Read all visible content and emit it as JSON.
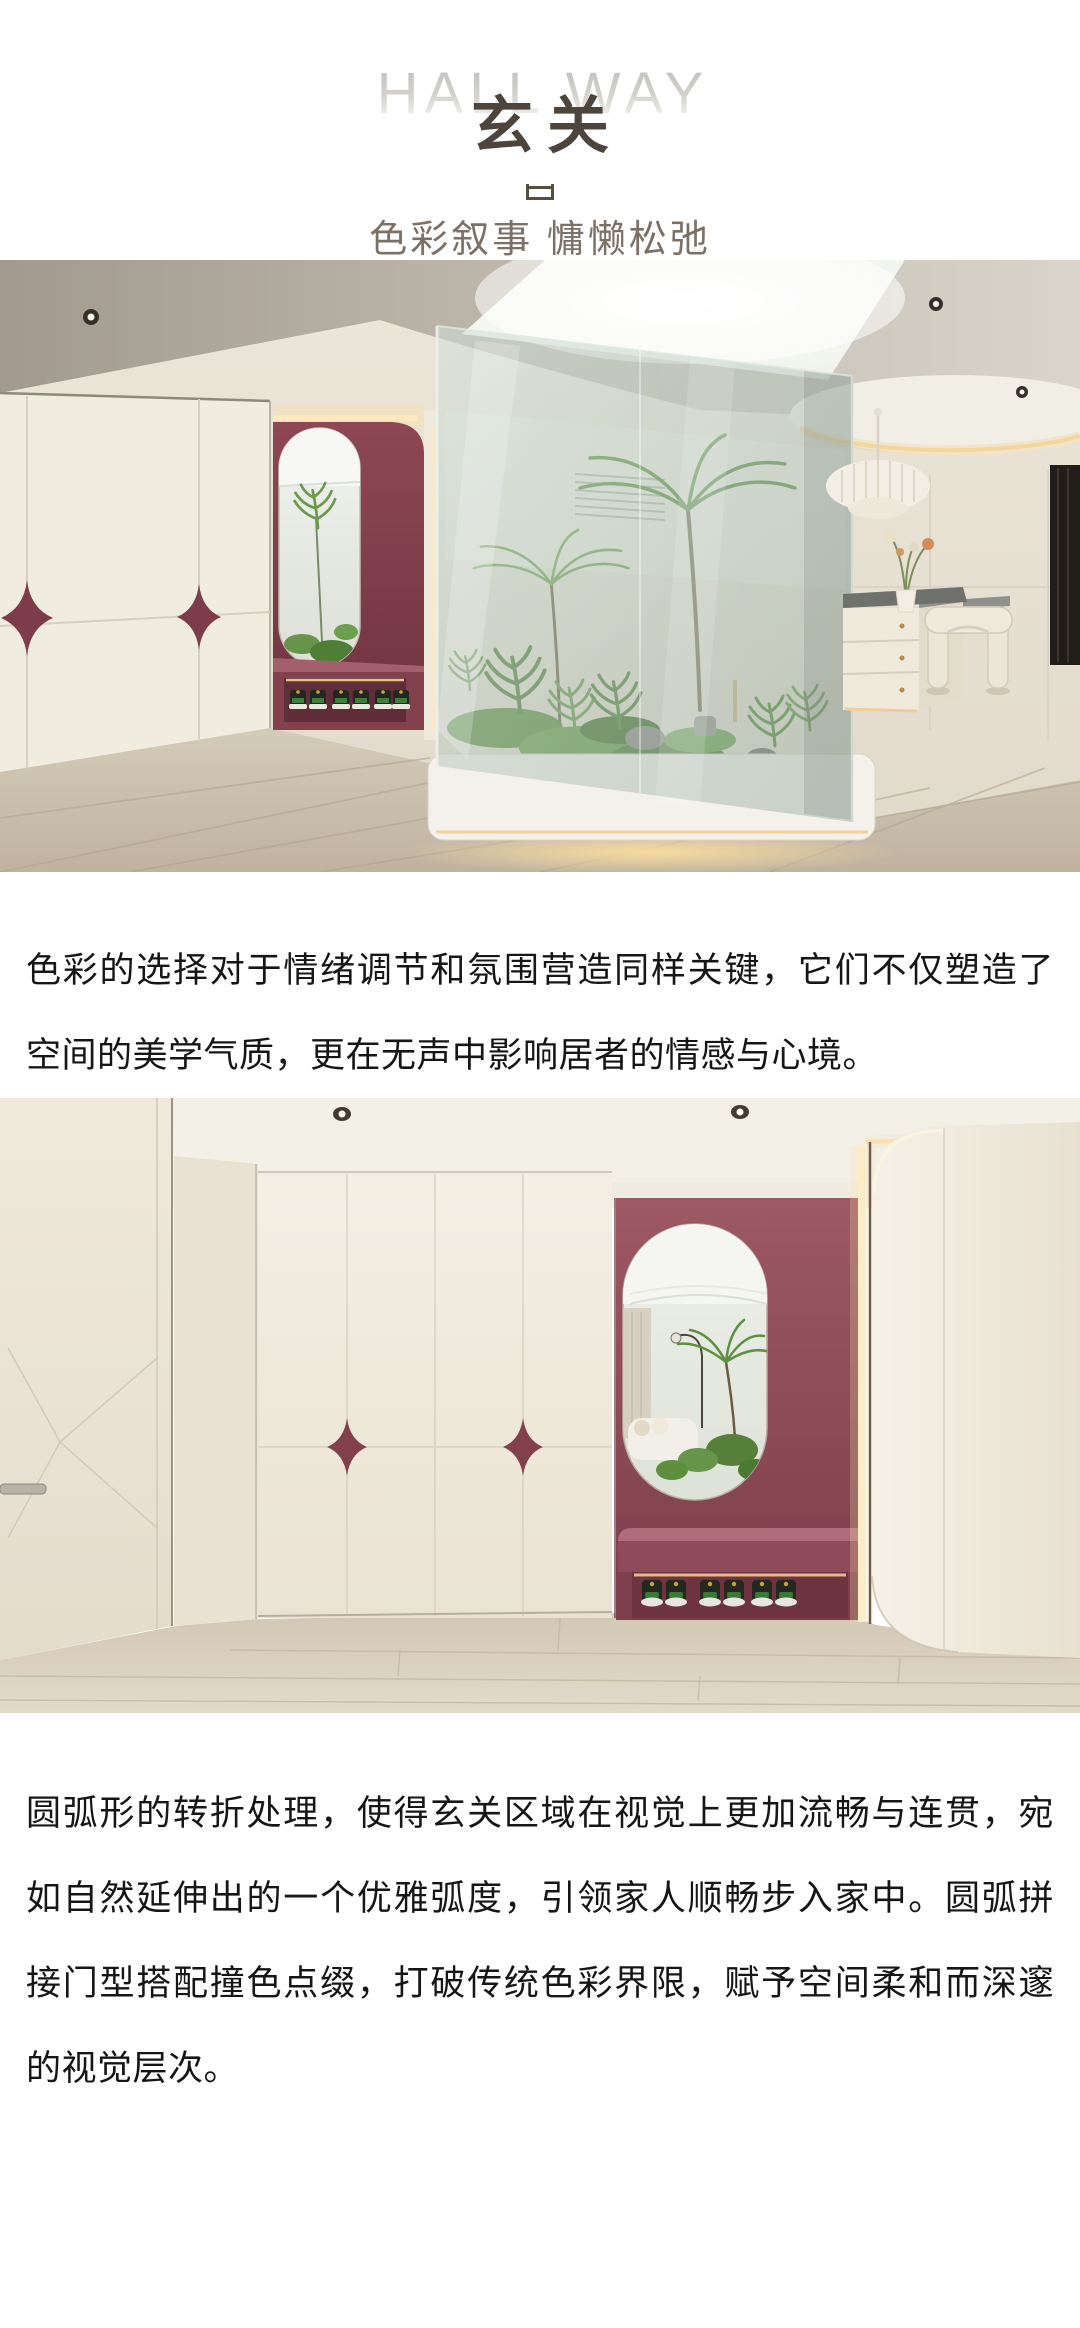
{
  "header": {
    "title_en": "HALL WAY",
    "title_cn": "玄关",
    "divider_icon": "open-top-frame-icon",
    "subtitle": "色彩叙事 慵懒松弛"
  },
  "photos": [
    {
      "alt": "玄关实景一：奶油色衣柜配酒红星形拉手，酒红色拱形换鞋区内嵌穿衣镜与球鞋，中部玻璃中庭天窗下绿植苔藓造景，右侧白色岛台、褶皱吊灯与弧形凳"
    },
    {
      "alt": "玄关实景二：圆弧拼接奶油色柜墙与星形撞色拉手，红色凹龛内嵌椭圆穿衣镜，镜中映出客厅绿植，下方换鞋凳与三双球鞋，右侧圆弧转角柜体"
    }
  ],
  "paragraphs": [
    "色彩的选择对于情绪调节和氛围营造同样关键，它们不仅塑造了空间的美学气质，更在无声中影响居者的情感与心境。",
    "圆弧形的转折处理，使得玄关区域在视觉上更加流畅与连贯，宛如自然延伸出的一个优雅弧度，引领家人顺畅步入家中。圆弧拼接门型搭配撞色点缀，打破传统色彩界限，赋予空间柔和而深邃的视觉层次。"
  ],
  "colors": {
    "page_background": "#ffffff",
    "title_cn": "#4d443b",
    "title_en_gray": "#c9c6c2",
    "subtitle": "#7b7166",
    "body_text": "#161616",
    "accent_maroon": "#8c4754",
    "cabinet_cream": "#f0ebdf",
    "floor_wood": "#cfc4b1"
  }
}
